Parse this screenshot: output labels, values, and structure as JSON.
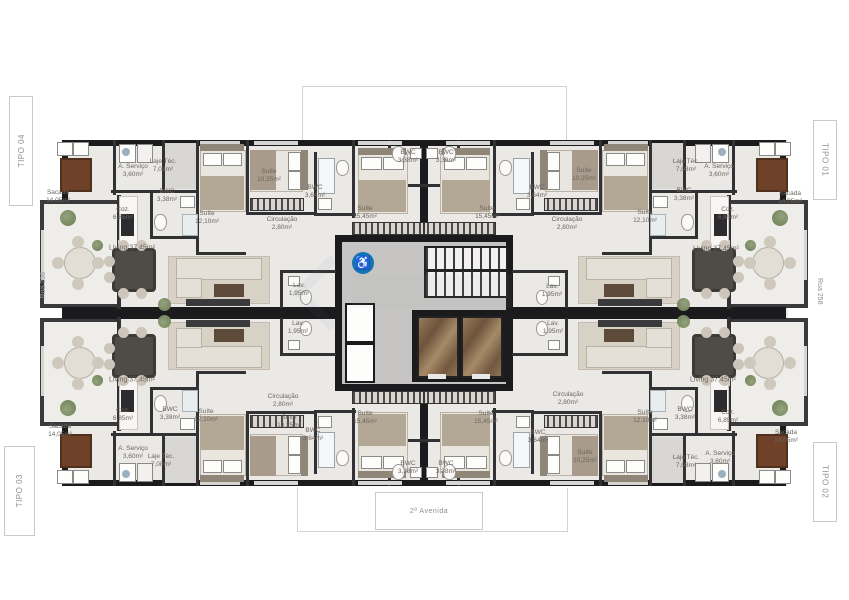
{
  "plan": {
    "units": {
      "tipo01": "TIPO 01",
      "tipo02": "TIPO 02",
      "tipo03": "TIPO 03",
      "tipo04": "TIPO 04"
    },
    "streets": {
      "left": "Rua 256",
      "right": "Rua 258",
      "bottom": "2ª Avenida"
    },
    "rooms": {
      "suite_1210": "Suíte\n12,10m²",
      "suite_1025": "Suíte\n10,25m²",
      "suite_1545": "Suíte\n15,45m²",
      "bwc_338": "BWC\n3,38m²",
      "bwc_364": "BWC\n3,64m²",
      "coz": "Coz.\n6,85m²",
      "servico": "A. Serviço\n3,60m²",
      "laje": "Laje Téc.\n7,08m²",
      "sacada": "Sacada\n14,05m²",
      "living": "Living 37,45m²",
      "circulacao": "Circulação\n2,80m²",
      "lav": "Lav.\n1,95m²"
    },
    "icons": {
      "accessibility": "♿"
    }
  }
}
